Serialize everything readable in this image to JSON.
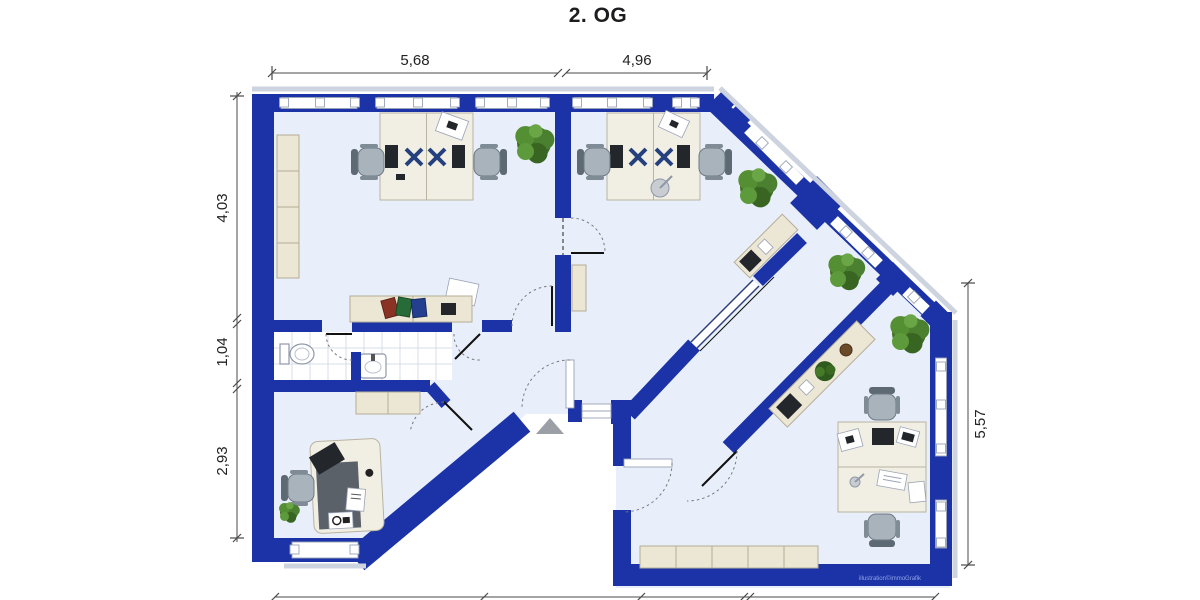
{
  "title": "2. OG",
  "credit": "illustration©immoGrafik",
  "dimensions": {
    "top_left_width": "5,68",
    "top_right_width": "4,96",
    "left_upper": "4,03",
    "left_middle": "1,04",
    "left_lower": "2,93",
    "right_height": "5,57"
  },
  "colors": {
    "wall": "#1b33a7",
    "floor": "#e9eefb",
    "furniture": "#ece6d4",
    "plant": "#4a7d2b",
    "dimension_text": "#222222"
  }
}
